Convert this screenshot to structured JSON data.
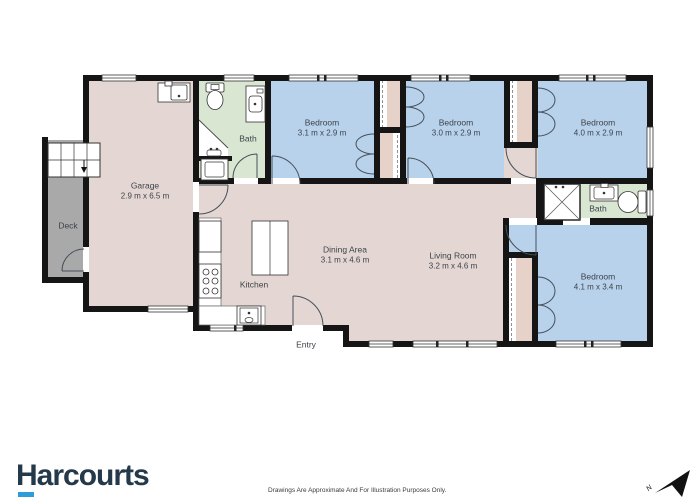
{
  "branding": {
    "logo_text": "Harcourts",
    "logo_color": "#24394a",
    "logo_underline_color": "#2d9cdb"
  },
  "footer": {
    "disclaimer": "Drawings Are Approximate And For Illustration Purposes Only."
  },
  "compass": {
    "label": "N"
  },
  "palette": {
    "floor_pink": "#e4d7d3",
    "wardrobe_pink": "#e7d2ca",
    "bedroom_blue": "#b8d2ec",
    "bath_green": "#d8e6d2",
    "deck_gray": "#a9a9a9",
    "wall_black": "#151515"
  },
  "rooms": [
    {
      "id": "garage",
      "name": "Garage",
      "dims": "2.9 m x 6.5 m"
    },
    {
      "id": "deck",
      "name": "Deck",
      "dims": ""
    },
    {
      "id": "bath-1",
      "name": "Bath",
      "dims": ""
    },
    {
      "id": "bedroom-1",
      "name": "Bedroom",
      "dims": "3.1 m x 2.9 m"
    },
    {
      "id": "bedroom-2",
      "name": "Bedroom",
      "dims": "3.0 m x 2.9 m"
    },
    {
      "id": "bedroom-3",
      "name": "Bedroom",
      "dims": "4.0 m x 2.9 m"
    },
    {
      "id": "bath-2",
      "name": "Bath",
      "dims": ""
    },
    {
      "id": "bedroom-4",
      "name": "Bedroom",
      "dims": "4.1 m x 3.4 m"
    },
    {
      "id": "dining",
      "name": "Dining Area",
      "dims": "3.1 m x 4.6 m"
    },
    {
      "id": "living",
      "name": "Living Room",
      "dims": "3.2 m x 4.6 m"
    },
    {
      "id": "kitchen",
      "name": "Kitchen",
      "dims": ""
    },
    {
      "id": "entry",
      "name": "Entry",
      "dims": ""
    }
  ]
}
